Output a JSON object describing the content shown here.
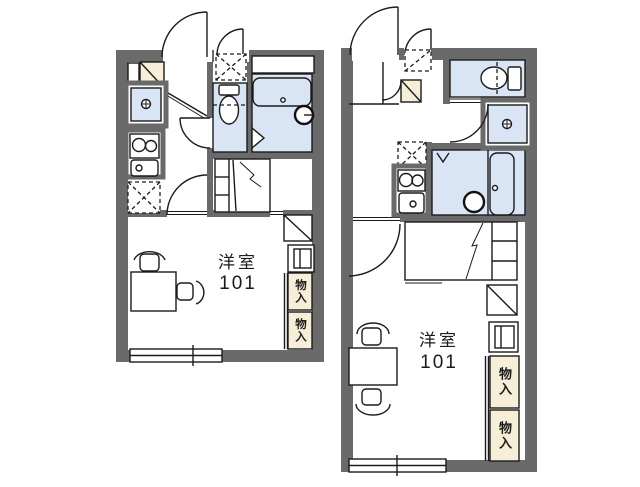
{
  "document": {
    "type": "apartment-floor-plan-pair",
    "background": "#ffffff"
  },
  "colors": {
    "wall": "#6a6a6a",
    "line": "#1b1b1b",
    "wet_area_fill": "#d9e4f4",
    "storage_fill": "#f7eed7",
    "floor_fill": "#ffffff"
  },
  "plans": [
    {
      "id": "left-unit",
      "room_label": "洋室",
      "room_number": "101",
      "closets": [
        "物入",
        "物入"
      ],
      "fixtures": [
        "entrance-door",
        "shoe-cabinet",
        "washing-machine-space",
        "toilet",
        "bathtub",
        "faucet",
        "refrigerator-space",
        "gas-stove",
        "kitchen-sink",
        "bed",
        "desk",
        "chair",
        "chair",
        "storage-shelf",
        "window"
      ]
    },
    {
      "id": "right-unit",
      "room_label": "洋室",
      "room_number": "101",
      "closets": [
        "物入",
        "物入"
      ],
      "fixtures": [
        "entrance-door",
        "shoe-cabinet",
        "washing-machine-space",
        "toilet",
        "bathtub",
        "shower-drain",
        "refrigerator-space",
        "gas-stove",
        "kitchen-sink",
        "bed",
        "desk",
        "chair",
        "chair",
        "storage-shelf",
        "window"
      ]
    }
  ]
}
